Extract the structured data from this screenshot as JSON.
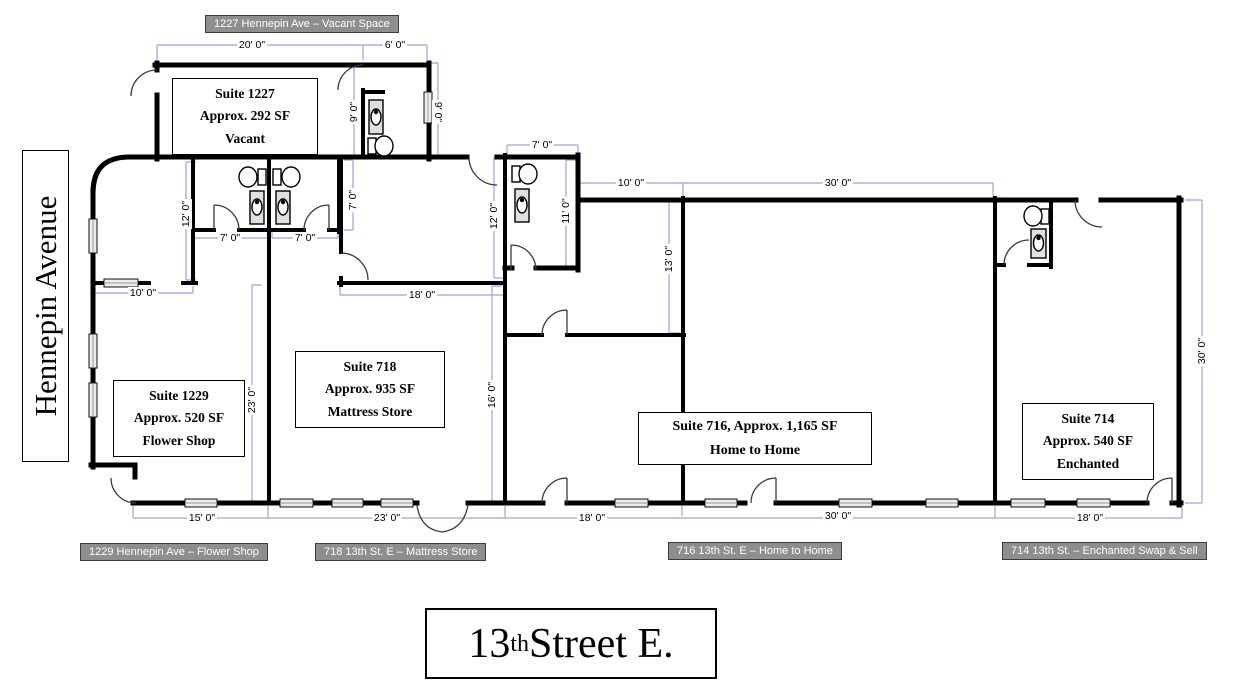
{
  "streets": {
    "left": "Hennepin Avenue",
    "bottom": {
      "num": "13",
      "sup": "th",
      "rest": " Street E."
    }
  },
  "address_tags": {
    "t1227": "1227 Hennepin Ave – Vacant Space",
    "t1229": "1229 Hennepin Ave – Flower Shop",
    "t718": "718 13th St. E – Mattress Store",
    "t716": "716 13th St. E – Home to Home",
    "t714": "714 13th St. – Enchanted Swap & Sell"
  },
  "suites": {
    "s1227": {
      "lines": [
        "Suite 1227",
        "Approx. 292 SF",
        "Vacant"
      ]
    },
    "s1229": {
      "lines": [
        "Suite 1229",
        "Approx. 520 SF",
        "Flower Shop"
      ]
    },
    "s718": {
      "lines": [
        "Suite 718",
        "Approx. 935 SF",
        "Mattress Store"
      ]
    },
    "s716": {
      "lines": [
        "Suite 716, Approx. 1,165 SF",
        "Home to Home"
      ]
    },
    "s714": {
      "lines": [
        "Suite 714",
        "Approx. 540 SF",
        "Enchanted"
      ]
    }
  },
  "dims": {
    "h1": "20' 0\"",
    "h2": "6' 0\"",
    "h3": "7' 0\"",
    "h4": "10' 0\"",
    "h5": "30' 0\"",
    "h6": "7' 0\"",
    "h7": "7' 0\"",
    "h8": "10' 0\"",
    "h9": "18' 0\"",
    "h10": "15' 0\"",
    "h11": "23' 0\"",
    "h12": "18' 0\"",
    "h13": "30' 0\"",
    "h14": "18' 0\"",
    "v1": "9' 0\"",
    "v2": "9' 0\"",
    "v3": "12' 0\"",
    "v4": "7' 0\"",
    "v5": "12' 0\"",
    "v6": "11' 0\"",
    "v7": "13' 0\"",
    "v8": "16' 0\"",
    "v9": "23' 0\"",
    "v10": "30' 0\""
  },
  "colors": {
    "wall": "#000000",
    "dimension_line": "#a0a0dd",
    "tag_background": "#8e8e8e",
    "tag_text": "#ffffff"
  }
}
